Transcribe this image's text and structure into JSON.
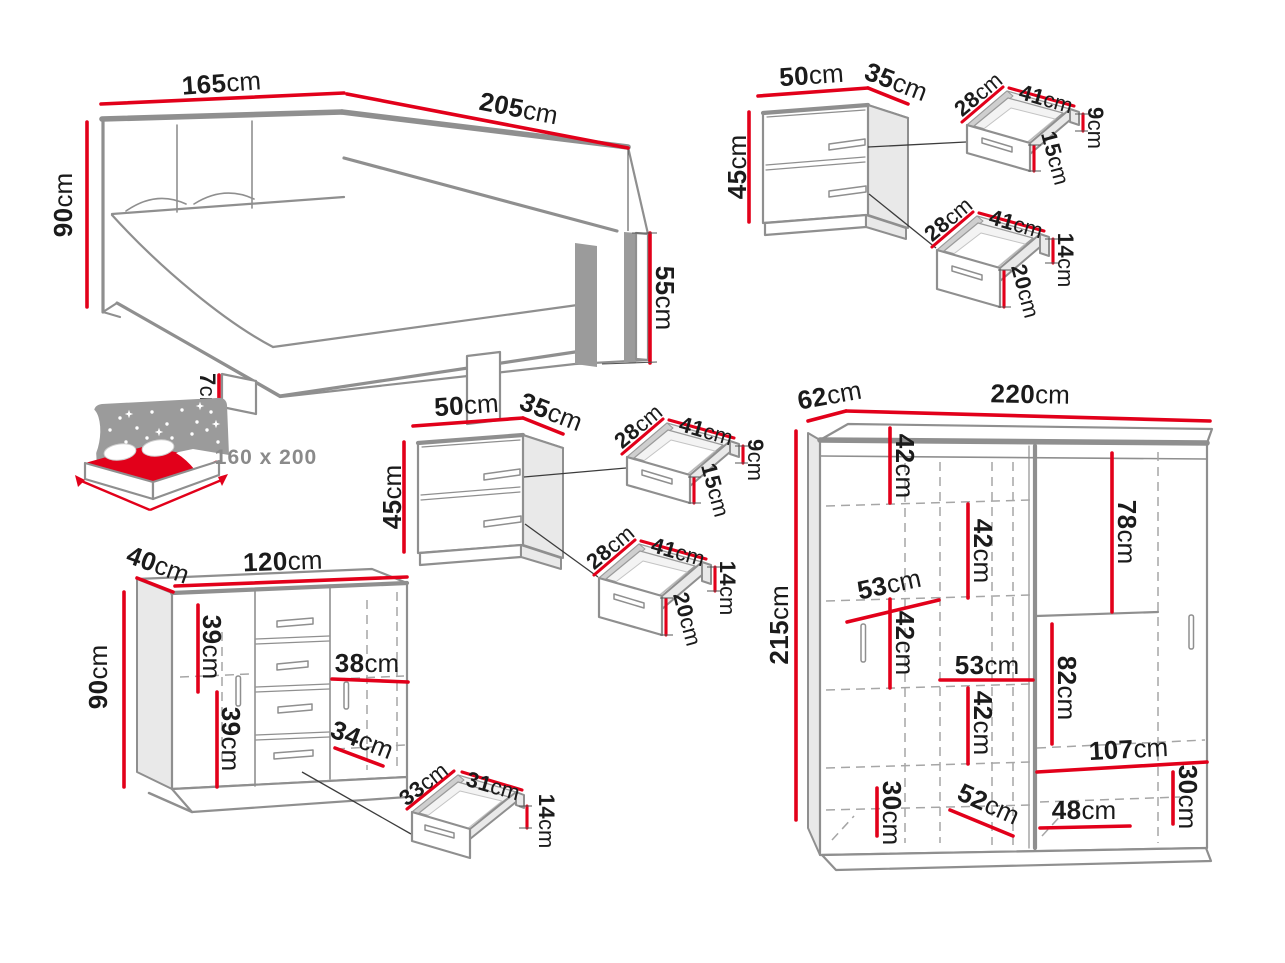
{
  "colors": {
    "dimension_red": "#e2001a",
    "furniture_gray": "#8f8f8f",
    "label_text": "#1b1b1b"
  },
  "bed": {
    "width": {
      "v": "165",
      "u": "cm"
    },
    "length": {
      "v": "205",
      "u": "cm"
    },
    "headboard_height": {
      "v": "90",
      "u": "cm"
    },
    "footboard_height": {
      "v": "55",
      "u": "cm"
    },
    "leg_height": {
      "v": "7",
      "u": "cm"
    },
    "mattress_size": "160 x 200"
  },
  "nightstand1": {
    "width": {
      "v": "50",
      "u": "cm"
    },
    "depth": {
      "v": "35",
      "u": "cm"
    },
    "height": {
      "v": "45",
      "u": "cm"
    },
    "drawer_top": {
      "depth": {
        "v": "28",
        "u": "cm"
      },
      "width": {
        "v": "41",
        "u": "cm"
      },
      "side_height": {
        "v": "9",
        "u": "cm"
      },
      "front_height": {
        "v": "15",
        "u": "cm"
      }
    },
    "drawer_bottom": {
      "depth": {
        "v": "28",
        "u": "cm"
      },
      "width": {
        "v": "41",
        "u": "cm"
      },
      "side_height": {
        "v": "14",
        "u": "cm"
      },
      "front_height": {
        "v": "20",
        "u": "cm"
      }
    }
  },
  "nightstand2": {
    "width": {
      "v": "50",
      "u": "cm"
    },
    "depth": {
      "v": "35",
      "u": "cm"
    },
    "height": {
      "v": "45",
      "u": "cm"
    },
    "drawer_top": {
      "depth": {
        "v": "28",
        "u": "cm"
      },
      "width": {
        "v": "41",
        "u": "cm"
      },
      "side_height": {
        "v": "9",
        "u": "cm"
      },
      "front_height": {
        "v": "15",
        "u": "cm"
      }
    },
    "drawer_bottom": {
      "depth": {
        "v": "28",
        "u": "cm"
      },
      "width": {
        "v": "41",
        "u": "cm"
      },
      "side_height": {
        "v": "14",
        "u": "cm"
      },
      "front_height": {
        "v": "20",
        "u": "cm"
      }
    }
  },
  "dresser": {
    "depth": {
      "v": "40",
      "u": "cm"
    },
    "width": {
      "v": "120",
      "u": "cm"
    },
    "height": {
      "v": "90",
      "u": "cm"
    },
    "upper_section": {
      "v": "39",
      "u": "cm"
    },
    "lower_section": {
      "v": "39",
      "u": "cm"
    },
    "door_inner_width": {
      "v": "38",
      "u": "cm"
    },
    "shelf_depth": {
      "v": "34",
      "u": "cm"
    },
    "drawer": {
      "depth": {
        "v": "33",
        "u": "cm"
      },
      "width": {
        "v": "31",
        "u": "cm"
      },
      "height": {
        "v": "14",
        "u": "cm"
      }
    }
  },
  "wardrobe": {
    "depth": {
      "v": "62",
      "u": "cm"
    },
    "width": {
      "v": "220",
      "u": "cm"
    },
    "height": {
      "v": "215",
      "u": "cm"
    },
    "left_shelf_1": {
      "v": "42",
      "u": "cm"
    },
    "left_shelf_2": {
      "v": "42",
      "u": "cm"
    },
    "left_width": {
      "v": "53",
      "u": "cm"
    },
    "left_shelf_3": {
      "v": "42",
      "u": "cm"
    },
    "mid_width": {
      "v": "53",
      "u": "cm"
    },
    "mid_shelf": {
      "v": "42",
      "u": "cm"
    },
    "bottom_left_height": {
      "v": "30",
      "u": "cm"
    },
    "bottom_depth": {
      "v": "52",
      "u": "cm"
    },
    "right_top_height": {
      "v": "78",
      "u": "cm"
    },
    "right_mid_height": {
      "v": "82",
      "u": "cm"
    },
    "right_width": {
      "v": "107",
      "u": "cm"
    },
    "bottom_right_height": {
      "v": "30",
      "u": "cm"
    },
    "bottom_right_width": {
      "v": "48",
      "u": "cm"
    }
  }
}
